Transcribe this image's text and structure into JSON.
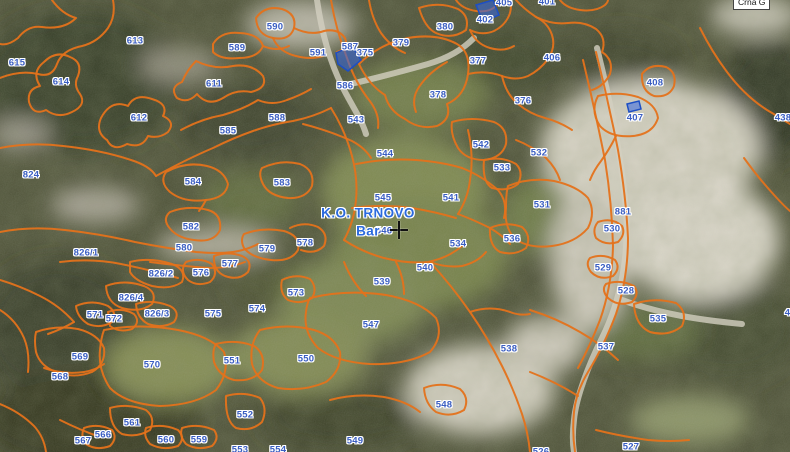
{
  "map": {
    "tooltip": "Crna G",
    "district_label": "K.O. TRNOVO",
    "place_label": "Bar",
    "colors": {
      "boundary": "#e4721b",
      "road": "#d3cfc0",
      "highlight_fill": "rgba(50,100,225,0.55)",
      "highlight_stroke": "#1d4fc4",
      "label_blue": "#3a5ec2",
      "big_label_blue": "#2b6ade"
    },
    "crosshair": {
      "x": 399,
      "y": 230
    },
    "big_labels": [
      {
        "t": "K.O. TRNOVO",
        "x": 368,
        "y": 213
      },
      {
        "t": "Bar",
        "x": 368,
        "y": 231
      }
    ],
    "labels": [
      {
        "t": "615",
        "x": 17,
        "y": 63
      },
      {
        "t": "613",
        "x": 135,
        "y": 41
      },
      {
        "t": "614",
        "x": 61,
        "y": 82
      },
      {
        "t": "612",
        "x": 139,
        "y": 118
      },
      {
        "t": "611",
        "x": 214,
        "y": 84
      },
      {
        "t": "589",
        "x": 237,
        "y": 48
      },
      {
        "t": "585",
        "x": 228,
        "y": 131
      },
      {
        "t": "588",
        "x": 277,
        "y": 118
      },
      {
        "t": "590",
        "x": 275,
        "y": 27
      },
      {
        "t": "591",
        "x": 318,
        "y": 53
      },
      {
        "t": "587",
        "x": 350,
        "y": 47
      },
      {
        "t": "375",
        "x": 365,
        "y": 53
      },
      {
        "t": "379",
        "x": 401,
        "y": 43
      },
      {
        "t": "380",
        "x": 445,
        "y": 27
      },
      {
        "t": "402",
        "x": 485,
        "y": 20
      },
      {
        "t": "405",
        "x": 504,
        "y": 3
      },
      {
        "t": "401",
        "x": 547,
        "y": 2
      },
      {
        "t": "406",
        "x": 552,
        "y": 58
      },
      {
        "t": "408",
        "x": 655,
        "y": 83
      },
      {
        "t": "407",
        "x": 635,
        "y": 118
      },
      {
        "t": "438",
        "x": 783,
        "y": 118
      },
      {
        "t": "376",
        "x": 523,
        "y": 101
      },
      {
        "t": "377",
        "x": 478,
        "y": 61
      },
      {
        "t": "378",
        "x": 438,
        "y": 95
      },
      {
        "t": "586",
        "x": 345,
        "y": 86
      },
      {
        "t": "543",
        "x": 356,
        "y": 120
      },
      {
        "t": "544",
        "x": 385,
        "y": 154
      },
      {
        "t": "542",
        "x": 481,
        "y": 145
      },
      {
        "t": "532",
        "x": 539,
        "y": 153
      },
      {
        "t": "533",
        "x": 502,
        "y": 168
      },
      {
        "t": "545",
        "x": 383,
        "y": 198
      },
      {
        "t": "541",
        "x": 451,
        "y": 198
      },
      {
        "t": "583",
        "x": 282,
        "y": 183
      },
      {
        "t": "584",
        "x": 193,
        "y": 182
      },
      {
        "t": "824",
        "x": 31,
        "y": 175
      },
      {
        "t": "582",
        "x": 191,
        "y": 227
      },
      {
        "t": "580",
        "x": 184,
        "y": 248
      },
      {
        "t": "579",
        "x": 267,
        "y": 249
      },
      {
        "t": "578",
        "x": 305,
        "y": 243
      },
      {
        "t": "577",
        "x": 230,
        "y": 264
      },
      {
        "t": "576",
        "x": 201,
        "y": 273
      },
      {
        "t": "826/1",
        "x": 86,
        "y": 253
      },
      {
        "t": "826/2",
        "x": 161,
        "y": 274
      },
      {
        "t": "826/4",
        "x": 131,
        "y": 298
      },
      {
        "t": "826/3",
        "x": 157,
        "y": 314
      },
      {
        "t": "571",
        "x": 95,
        "y": 315
      },
      {
        "t": "572",
        "x": 114,
        "y": 319
      },
      {
        "t": "573",
        "x": 296,
        "y": 293
      },
      {
        "t": "574",
        "x": 257,
        "y": 309
      },
      {
        "t": "575",
        "x": 213,
        "y": 314
      },
      {
        "t": "531",
        "x": 542,
        "y": 205
      },
      {
        "t": "881",
        "x": 623,
        "y": 212
      },
      {
        "t": "530",
        "x": 612,
        "y": 229
      },
      {
        "t": "536",
        "x": 512,
        "y": 239
      },
      {
        "t": "534",
        "x": 458,
        "y": 244
      },
      {
        "t": "538",
        "x": 509,
        "y": 349
      },
      {
        "t": "540",
        "x": 425,
        "y": 268
      },
      {
        "t": "539",
        "x": 382,
        "y": 282
      },
      {
        "t": "529",
        "x": 603,
        "y": 268
      },
      {
        "t": "528",
        "x": 626,
        "y": 291
      },
      {
        "t": "535",
        "x": 658,
        "y": 319
      },
      {
        "t": "537",
        "x": 606,
        "y": 347
      },
      {
        "t": "527",
        "x": 631,
        "y": 447
      },
      {
        "t": "547",
        "x": 371,
        "y": 325
      },
      {
        "t": "550",
        "x": 306,
        "y": 359
      },
      {
        "t": "548",
        "x": 444,
        "y": 405
      },
      {
        "t": "549",
        "x": 355,
        "y": 441
      },
      {
        "t": "569",
        "x": 80,
        "y": 357
      },
      {
        "t": "570",
        "x": 152,
        "y": 365
      },
      {
        "t": "551",
        "x": 232,
        "y": 361
      },
      {
        "t": "568",
        "x": 60,
        "y": 377
      },
      {
        "t": "552",
        "x": 245,
        "y": 415
      },
      {
        "t": "561",
        "x": 132,
        "y": 423
      },
      {
        "t": "566",
        "x": 103,
        "y": 435
      },
      {
        "t": "567",
        "x": 83,
        "y": 441
      },
      {
        "t": "560",
        "x": 166,
        "y": 440
      },
      {
        "t": "559",
        "x": 199,
        "y": 440
      },
      {
        "t": "553",
        "x": 240,
        "y": 450
      },
      {
        "t": "554",
        "x": 278,
        "y": 450
      },
      {
        "t": "526",
        "x": 541,
        "y": 452
      },
      {
        "t": "438",
        "x": 793,
        "y": 313
      },
      {
        "t": "546",
        "x": 384,
        "y": 231
      }
    ],
    "highlights": [
      "336,53 352,46 361,60 348,71 338,64",
      "476,5 493,0 499,15 483,22",
      "627,104 639,101 641,109 629,112"
    ],
    "roads": [
      "M 597,48 C 610,100 622,160 626,210 C 629,252 622,298 602,338 C 588,366 576,398 574,420 C 572,436 573,446 574,452",
      "M 317,0 C 321,28 328,58 342,86 C 352,106 362,120 366,134",
      "M 342,86 C 368,80 400,72 428,64 C 448,58 462,50 474,38",
      "M 622,300 C 660,314 700,320 742,324"
    ],
    "boundaries": [
      "M 52,0 Q 62,14 76,18 Q 64,30 42,27 Q 28,25 18,38 Q 8,46 0,44",
      "M 113,0 Q 116,16 108,28 Q 98,42 82,46 Q 62,50 57,64 Q 52,78 38,74 Q 20,70 0,78",
      "M 44,62 Q 56,50 70,57 Q 83,62 78,76 Q 73,85 80,94 Q 87,105 72,112 Q 58,119 46,110 Q 33,116 29,102 Q 27,89 40,86 Q 31,72 44,62 Z",
      "M 101,118 Q 111,99 128,106 Q 135,93 152,99 Q 169,104 163,116 Q 176,122 168,132 Q 159,139 148,136 Q 142,149 127,144 Q 113,152 107,140 Q 95,132 101,118 Z",
      "M 213,44 Q 221,31 240,33 Q 259,34 263,46 Q 258,58 239,58 Q 221,60 213,52 Z",
      "M 263,46 Q 277,52 289,46",
      "M 196,61 Q 214,70 233,66 Q 252,63 263,76 Q 268,88 251,92 Q 236,89 223,98 Q 208,107 197,94 Q 188,104 177,98 Q 169,87 182,82 Q 187,70 196,61 Z",
      "M 156,176 Q 187,159 213,148 Q 233,138 253,131 Q 273,124 293,121 Q 313,117 331,108",
      "M 181,130 Q 201,119 223,115 Q 244,109 258,100 Q 272,106 287,100 Q 301,95 311,89",
      "M 256,18 Q 265,5 282,9 Q 297,14 294,28 Q 290,41 273,38 Q 257,35 256,18 Z",
      "M 294,28 Q 310,36 324,31 Q 338,28 345,38 Q 349,48 337,52",
      "M 273,38 Q 279,52 296,56 Q 311,60 323,56",
      "M 331,0 Q 336,30 347,58 Q 355,82 369,100 Q 380,114 378,128",
      "M 369,0 Q 372,19 381,33 Q 391,47 405,53",
      "M 359,64 Q 379,44 408,38 Q 437,33 457,44 Q 471,52 468,74 Q 465,96 447,104 Q 452,119 437,126 Q 419,130 405,119 Q 389,111 385,95 Q 369,85 359,64 Z",
      "M 447,62 Q 429,72 419,87 Q 411,99 416,112",
      "M 419,8 Q 439,1 458,9 Q 470,16 466,30 Q 452,40 436,33 Q 425,28 419,8 Z",
      "M 470,30 Q 482,36 494,31 Q 506,25 510,13 Q 512,5 510,0",
      "M 470,30 Q 476,44 490,48 Q 504,52 514,46",
      "M 456,0 Q 462,9 476,11 Q 492,13 498,3 Q 499,1 499,0",
      "M 468,74 Q 486,70 502,76 Q 516,81 528,76 Q 540,70 548,59 Q 556,47 552,35 Q 548,23 536,17 Q 524,9 516,0",
      "M 502,76 Q 506,94 518,104 Q 530,114 545,118 Q 560,122 572,130",
      "M 536,17 Q 552,25 568,23 Q 584,21 596,29 Q 607,38 602,52 Q 614,60 610,74 Q 604,86 592,90",
      "M 560,0 Q 566,8 580,10 Q 596,12 605,5 Q 608,2 608,0",
      "M 642,74 Q 650,63 666,67 Q 677,72 674,86 Q 669,98 654,96 Q 641,91 642,74 Z",
      "M 598,96 Q 618,91 638,97 Q 656,104 658,118 Q 653,134 633,136 Q 611,138 600,126 Q 590,111 598,96 Z",
      "M 616,136 Q 609,150 601,161 Q 594,170 590,180",
      "M 700,28 Q 712,52 727,72 Q 745,96 767,110 Q 779,117 790,124",
      "M 744,158 Q 760,180 775,196 Q 785,207 790,211",
      "M 0,148 Q 31,142 63,146 Q 101,150 131,160 Q 150,166 156,176",
      "M 166,172 Q 186,161 207,166 Q 224,170 228,184 Q 226,198 206,200 Q 184,203 170,192 Q 159,182 166,172 Z",
      "M 170,212 Q 188,205 208,210 Q 222,214 220,230 Q 214,243 194,240 Q 176,238 168,226 Q 163,218 170,212 Z",
      "M 206,200 Q 203,206 199,211",
      "M 0,232 Q 31,226 65,230 Q 101,234 135,242 Q 165,248 196,252 Q 217,254 233,252 Q 247,250 258,244",
      "M 150,262 Q 181,266 209,268 Q 229,268 245,262",
      "M 244,234 Q 262,227 284,231 Q 301,236 298,250 Q 291,262 271,260 Q 252,258 244,248 Q 240,240 244,234 Z",
      "M 290,228 Q 304,221 318,227 Q 329,234 324,246 Q 315,255 301,250",
      "M 214,256 Q 228,251 242,256 Q 253,261 248,272 Q 239,281 225,276 Q 213,271 214,256 Z",
      "M 186,262 Q 200,257 212,264 Q 219,274 210,282 Q 197,287 188,280 Q 179,271 186,262 Z",
      "M 60,262 Q 91,258 121,264 Q 151,270 178,278",
      "M 130,262 Q 150,257 172,264 Q 187,270 182,282 Q 171,290 152,286 Q 135,281 130,272 Z",
      "M 106,286 Q 124,279 144,286 Q 158,292 152,304 Q 141,313 122,308 Q 107,303 106,286 Z",
      "M 136,304 Q 152,299 170,306 Q 181,312 174,322 Q 163,329 148,324 Q 137,318 136,304 Z",
      "M 76,306 Q 92,299 108,306 Q 118,313 112,322 Q 101,329 88,324 Q 77,317 76,306 Z",
      "M 108,312 Q 122,307 134,314 Q 141,322 132,329 Q 119,333 110,326 Z",
      "M 262,168 Q 281,159 300,164 Q 315,170 312,186 Q 306,199 288,198 Q 269,196 263,184 Q 258,174 262,168 Z",
      "M 331,108 Q 345,130 352,156 Q 358,178 356,200 Q 354,222 344,240",
      "M 468,130 Q 474,156 470,180 Q 468,198 458,214",
      "M 356,164 Q 386,158 416,160 Q 442,162 462,168",
      "M 352,208 Q 382,204 412,208 Q 436,212 456,218",
      "M 462,168 Q 482,176 498,190 Q 508,202 504,218",
      "M 344,240 Q 362,252 384,258 Q 408,264 428,262 Q 448,258 462,246",
      "M 458,214 Q 474,220 490,228 Q 502,235 510,244",
      "M 430,262 Q 446,268 462,266 Q 478,262 486,252",
      "M 490,228 Q 506,221 522,227 Q 532,236 526,248 Q 515,256 500,252 Q 489,246 490,228 Z",
      "M 396,262 Q 404,278 404,294",
      "M 344,262 Q 352,282 366,296",
      "M 282,280 Q 296,273 310,279 Q 318,288 312,298 Q 301,305 288,300 Q 279,293 282,280 Z",
      "M 508,186 Q 530,177 554,181 Q 577,186 588,198 Q 596,212 588,228 Q 575,243 552,246 Q 528,249 514,238 Q 504,226 506,208 Q 506,193 508,186 Z",
      "M 596,52 Q 608,100 618,150 Q 626,196 628,238 Q 628,278 616,314 Q 604,346 588,372 Q 576,392 574,412 Q 572,432 575,452",
      "M 583,60 Q 595,110 605,160 Q 612,204 613,246 Q 612,286 600,320 Q 590,346 578,368",
      "M 598,222 Q 612,217 622,226 Q 626,234 618,242 Q 605,246 596,238 Q 592,229 598,222 Z",
      "M 590,258 Q 603,253 615,260 Q 621,268 613,276 Q 600,281 591,272 Q 585,264 590,258 Z",
      "M 606,284 Q 620,279 634,286 Q 640,294 632,302 Q 618,307 608,298 Q 601,290 606,284 Z",
      "M 36,332 Q 56,325 78,329 Q 98,334 104,348 Q 106,364 92,372 Q 74,379 56,372 Q 40,366 36,352 Q 34,340 36,332 Z",
      "M 44,368 Q 64,375 84,372 Q 96,370 104,364",
      "M 104,330 Q 140,323 178,330 Q 210,336 224,352 Q 230,372 216,390 Q 196,405 160,406 Q 126,404 110,388 Q 98,370 100,350 Q 101,338 104,330 Z",
      "M 216,344 Q 236,339 254,346 Q 266,354 262,370 Q 253,382 234,380 Q 219,376 214,362 Q 212,350 216,344 Z",
      "M 226,396 Q 244,391 260,398 Q 268,408 262,422 Q 251,432 236,428 Q 225,421 226,396 Z",
      "M 110,408 Q 128,403 146,410 Q 156,418 150,430 Q 137,438 122,434 Q 110,427 110,408 Z",
      "M 84,428 Q 98,423 112,430 Q 118,438 110,446 Q 96,451 86,444 Q 80,436 84,428 Z",
      "M 146,428 Q 162,423 178,430 Q 186,438 178,446 Q 163,451 150,444 Q 143,436 146,428 Z",
      "M 182,428 Q 198,423 214,430 Q 220,438 212,446 Q 197,451 186,444 Q 179,436 182,428 Z",
      "M 60,420 Q 80,430 100,437",
      "M 310,298 Q 346,289 386,295 Q 420,301 436,318 Q 444,336 430,352 Q 407,365 370,364 Q 336,362 318,348 Q 303,332 306,312 Q 307,303 310,298 Z",
      "M 260,330 Q 288,323 314,330 Q 334,336 340,352 Q 342,370 326,382 Q 303,392 278,388 Q 257,382 252,364 Q 249,344 260,330 Z",
      "M 330,400 Q 356,393 384,397 Q 406,401 420,412",
      "M 424,388 Q 442,381 460,389 Q 470,398 464,410 Q 451,418 436,412 Q 425,404 424,388 Z",
      "M 430,262 Q 452,286 470,312 Q 488,338 502,366 Q 514,390 522,414 Q 528,432 530,452",
      "M 470,312 Q 490,305 510,312 Q 520,316 530,314",
      "M 634,304 Q 654,297 676,303 Q 688,312 682,326 Q 669,337 650,332 Q 635,325 634,304 Z",
      "M 530,310 Q 556,318 580,332 Q 601,344 618,360",
      "M 530,372 Q 556,382 578,396",
      "M 596,430 Q 620,436 648,440 Q 669,442 689,440",
      "M 0,310 Q 16,320 24,338 Q 30,352 28,372",
      "M 0,404 Q 20,412 34,426 Q 44,437 46,452",
      "M 0,280 Q 20,286 40,296 Q 60,306 74,322",
      "M 74,322 Q 62,329 48,334",
      "M 303,124 Q 330,131 352,141 Q 365,148 371,158",
      "M 452,122 Q 472,116 494,122 Q 508,128 506,144 Q 502,158 484,160 Q 466,160 458,148 Q 450,134 452,122 Z",
      "M 484,160 Q 502,156 516,164 Q 524,172 518,184 Q 508,192 492,188 Q 482,182 484,160 Z",
      "M 516,140 Q 532,146 546,158 Q 556,168 560,180"
    ]
  }
}
